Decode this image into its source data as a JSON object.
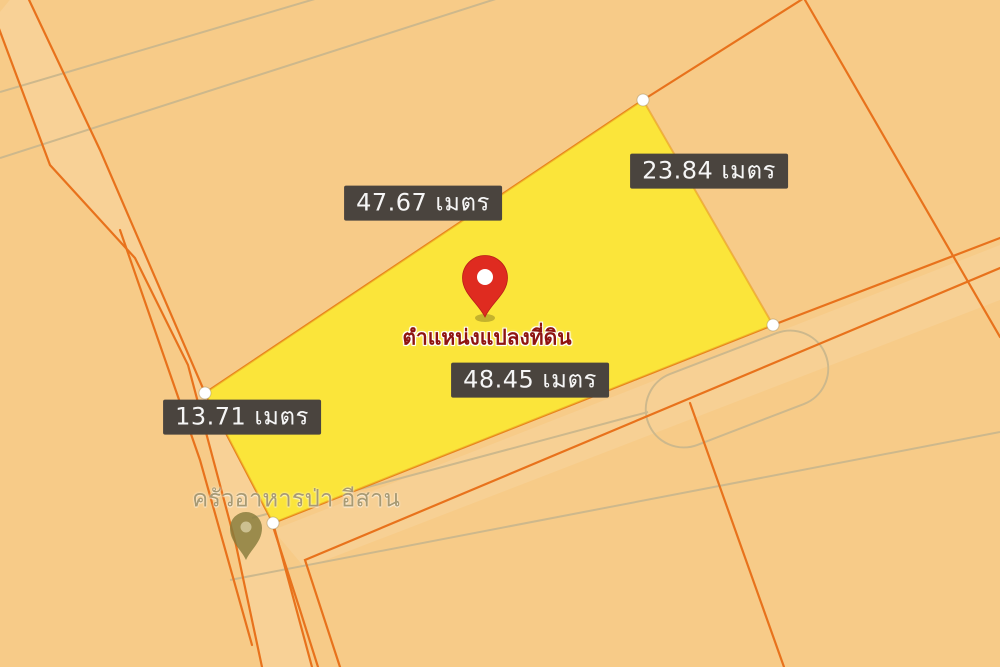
{
  "map": {
    "parcel": {
      "caption": "ตำแหน่งแปลงที่ดิน",
      "measurements": {
        "top": "47.67 เมตร",
        "right": "23.84 เมตร",
        "bottom": "48.45 เมตร",
        "left": "13.71 เมตร"
      }
    },
    "poi": {
      "name": "ครัวอาหารป่า อีสาน"
    },
    "colors": {
      "map_bg": "#F7CB88",
      "parcel_fill": "#FBE53A",
      "parcel_stroke": "#E8941C",
      "boundary_line": "#E8721C",
      "road_line": "#CDB88C",
      "pin_red": "#DF2B20",
      "caption_red": "#8F1410",
      "label_bg": "#4A443E",
      "label_text": "#F5F5F5",
      "poi_pin_color": "#867B3C",
      "poi_text": "#A89A73"
    }
  }
}
